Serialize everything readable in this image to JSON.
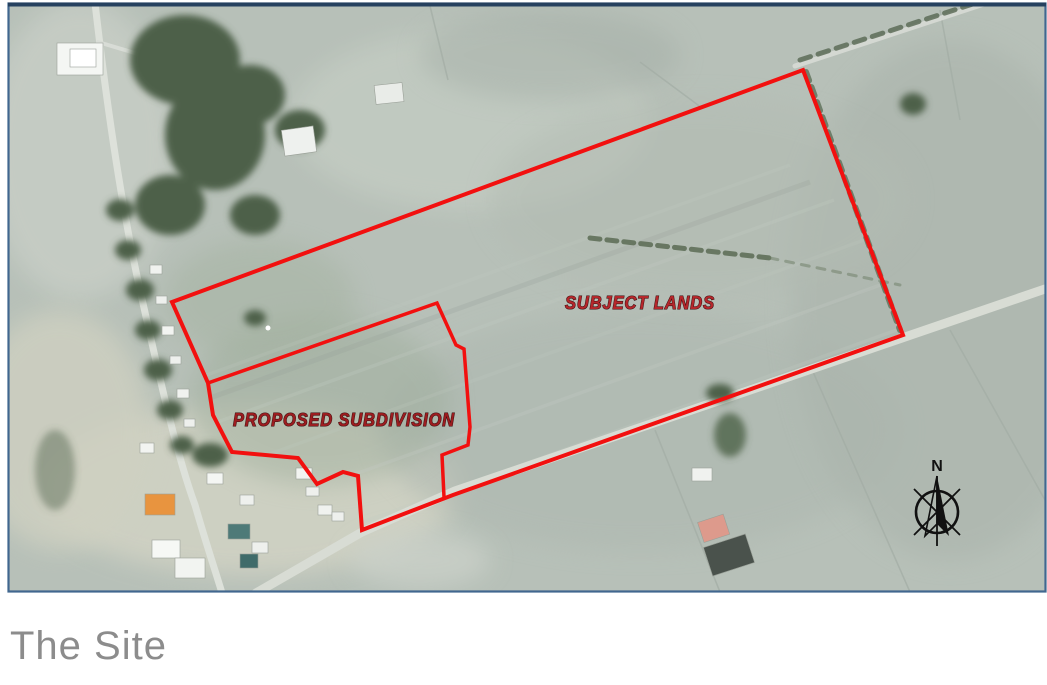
{
  "caption": {
    "text": "The Site",
    "color": "#8c8c8c"
  },
  "map": {
    "type": "aerial-photo-with-site-boundary",
    "frame_border_color": "#41678f",
    "boundary_color": "#f2100f",
    "labels": {
      "subject_lands": {
        "text": "SUBJECT LANDS",
        "color": "#b5272b"
      },
      "proposed_subdivision": {
        "text": "PROPOSED SUBDIVISION",
        "color": "#9c1d20"
      }
    },
    "compass": {
      "north_label": "N"
    },
    "boundary": {
      "outer_points": "172,302 803,70 903,335 453,495 362,530 358,476 343,472 317,484 298,458 232,452 213,415 208,383",
      "divider_points": "208,383 437,303 456,345 464,349 470,427 468,445 442,455 444,497"
    }
  }
}
